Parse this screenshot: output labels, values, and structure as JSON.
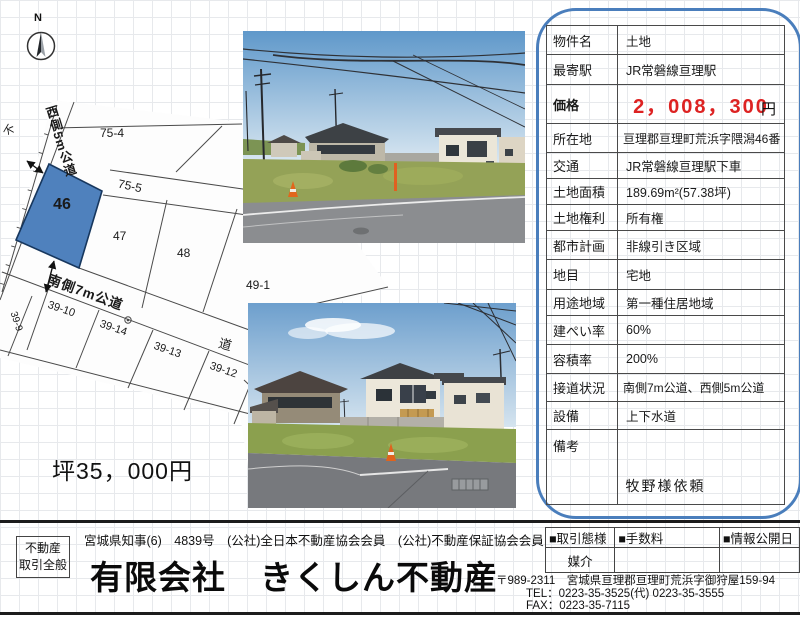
{
  "compass": {
    "north_label": "N"
  },
  "map": {
    "subject_parcel": "46",
    "parcels": {
      "p75_4": "75-4",
      "p75_5": "75-5",
      "p47": "47",
      "p48": "48",
      "p49_1": "49-1",
      "p39_10": "39-10",
      "p39_14": "39-14",
      "p39_13": "39-13",
      "p39_12": "39-12",
      "p39_9": "39-9"
    },
    "labels": {
      "west_road": "西側5m公道",
      "south_road": "南側7m公道",
      "road": "道",
      "edge_char": "不"
    },
    "colors": {
      "subject_fill": "#4f81bd",
      "subject_stroke": "#17375e"
    },
    "tsubo_price": "坪35，000円"
  },
  "info_table": {
    "price_color": "#dd2222",
    "rows": [
      {
        "label": "物件名",
        "value": "土地"
      },
      {
        "label": "最寄駅",
        "value": "JR常磐線亘理駅"
      },
      {
        "label": "価格",
        "value": "2，008，300",
        "unit": "円"
      },
      {
        "label": "所在地",
        "value": "亘理郡亘理町荒浜字隈潟46番"
      },
      {
        "label": "交通",
        "value": "JR常磐線亘理駅下車"
      },
      {
        "label": "土地面積",
        "value": "189.69m²(57.38坪)"
      },
      {
        "label": "土地権利",
        "value": "所有権"
      },
      {
        "label": "都市計画",
        "value": "非線引き区域"
      },
      {
        "label": "地目",
        "value": "宅地"
      },
      {
        "label": "用途地域",
        "value": "第一種住居地域"
      },
      {
        "label": "建ぺい率",
        "value": "60%"
      },
      {
        "label": "容積率",
        "value": "200%"
      },
      {
        "label": "接道状況",
        "value": "南側7m公道、西側5m公道"
      },
      {
        "label": "設備",
        "value": "上下水道"
      },
      {
        "label": "備考",
        "value": "",
        "note": "牧野様依頼"
      }
    ]
  },
  "footer": {
    "license_badge_line1": "不動産",
    "license_badge_line2": "取引全般",
    "license_text": "宮城県知事(6)　4839号　(公社)全日本不動産協会会員　(公社)不動産保証協会会員",
    "company_name": "有限会社　きくしん不動産",
    "deal_table": {
      "headers": [
        "■取引態様",
        "■手数料",
        "■情報公開日"
      ],
      "row": [
        "媒介",
        "",
        ""
      ]
    },
    "address": "〒989-2311　宮城県亘理郡亘理町荒浜字御狩屋159-94",
    "tel": "TEL：0223-35-3525(代) 0223-35-3555",
    "fax": "FAX：0223-35-7115"
  }
}
